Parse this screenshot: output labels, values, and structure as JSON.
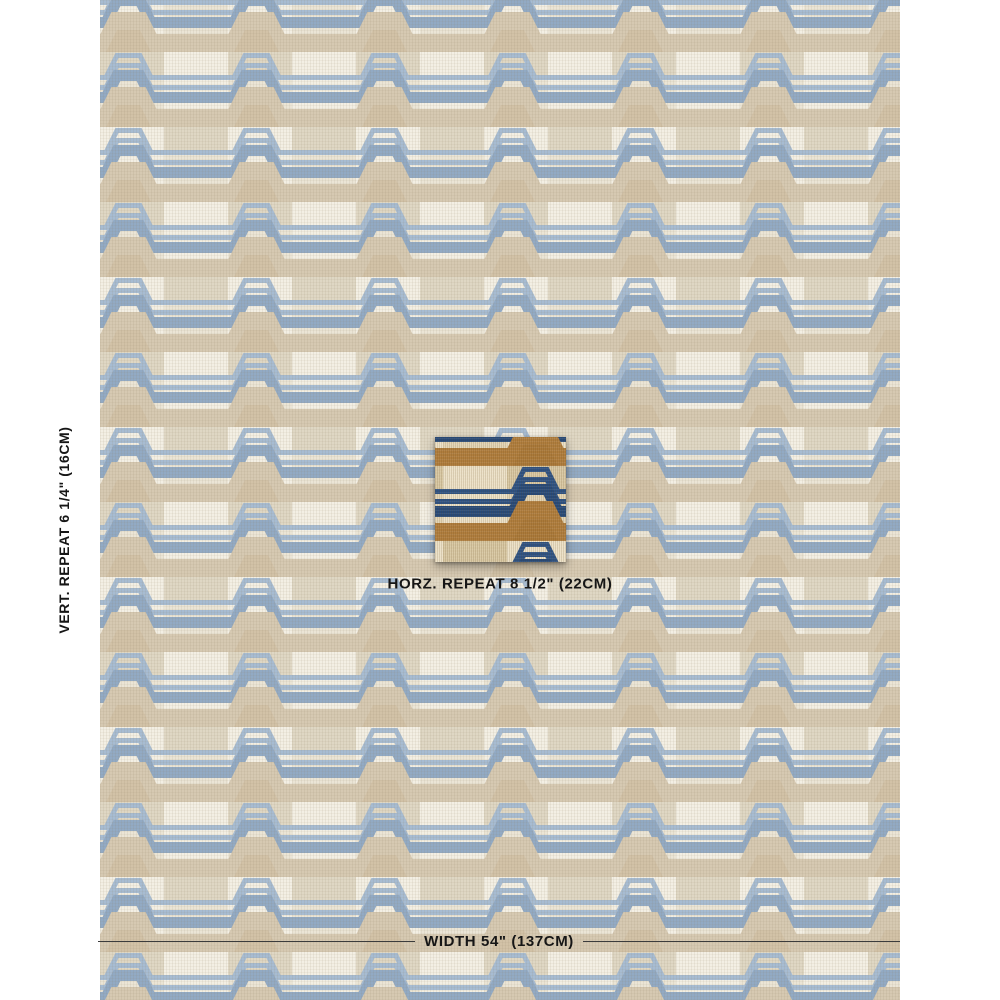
{
  "labels": {
    "vertical_repeat": "VERT. REPEAT 6 1/4\" (16CM)",
    "horizontal_repeat": "HORZ. REPEAT 8 1/2\" (22CM)",
    "width": "WIDTH 54\" (137CM)"
  },
  "colors": {
    "page_background": "#ffffff",
    "annotation_text": "#161616",
    "width_line": "#3c3c3c",
    "fabric": {
      "cream": "#f3efe4",
      "block_light": "#ebe5d6",
      "block_dark": "#dfd7c4",
      "blue_thin": "#a7bcd2",
      "blue_thick": "#92aac4",
      "tan_band": "#d6c9b2",
      "tan_fill": "#d2c2a7"
    },
    "swatch": {
      "cream": "#ece1c8",
      "block_light": "#e3d5b6",
      "block_dark": "#d8c8a4",
      "navy_thin": "#2d5284",
      "navy_thick": "#274a7a",
      "gold_band": "#b07e3e",
      "gold_fill": "#ab7a3a"
    }
  }
}
